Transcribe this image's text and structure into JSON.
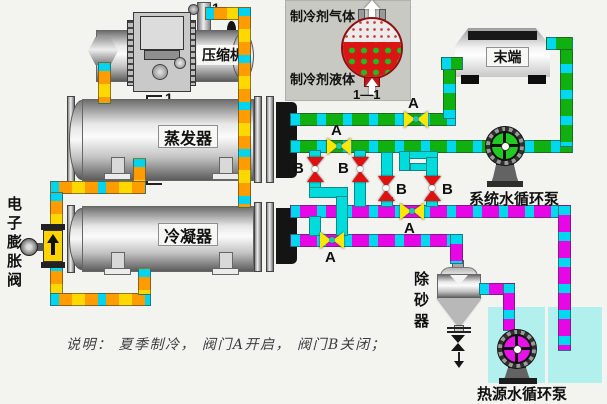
{
  "labels": {
    "compressor": "压缩机",
    "evaporator": "蒸发器",
    "condenser": "冷凝器",
    "terminal": "末端",
    "expansion_valve": "电子膨胀阀",
    "system_pump": "系统水循环泵",
    "sand_remover": "除砂器",
    "heat_source_pump": "热源水循环泵"
  },
  "inset": {
    "gas": "制冷剂气体",
    "liquid": "制冷剂液体",
    "section": "1—1"
  },
  "marks": {
    "one": "1"
  },
  "valve_labels": {
    "a": "A",
    "b": "B"
  },
  "note": "说明： 夏季制冷， 阀门A开启， 阀门B关闭；",
  "colors": {
    "chilled_water_pipe": "#10b010",
    "source_water_pipe": "#e606e6",
    "refrigerant_pipe": "#ff9d00",
    "crossover_pipe": "#00dcdc",
    "valve_a": "#ffe800",
    "valve_b": "#e01010",
    "pool": "#b2f0ee",
    "system_pump_wheel": "#23c923",
    "heat_pump_wheel": "#e612e6"
  }
}
